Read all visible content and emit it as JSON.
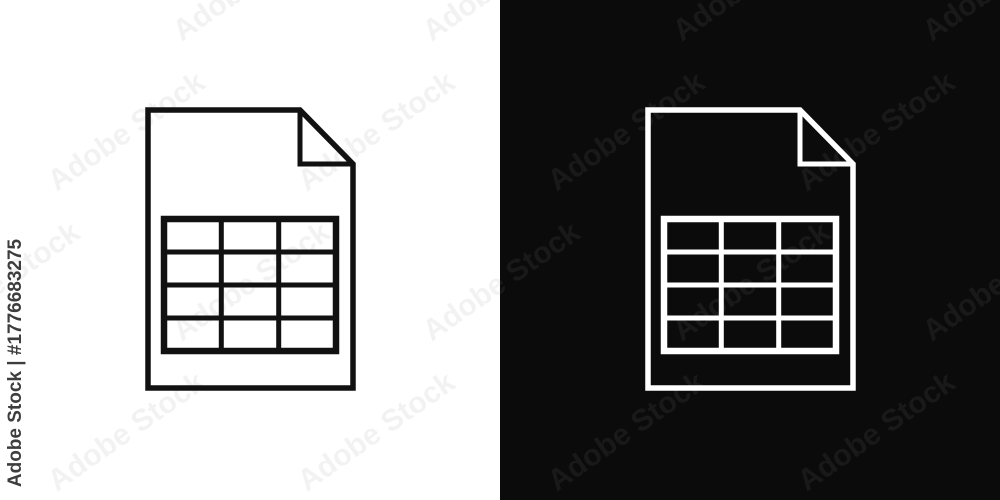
{
  "watermark": {
    "tile_text": "Adobe Stock",
    "id_text": "Adobe Stock | #1776683275"
  },
  "icon": {
    "name": "spreadsheet-file-icon",
    "description_visible_structure": {
      "table_columns": 3,
      "table_rows": 4,
      "folded_corner": "top-right"
    }
  },
  "panels": [
    {
      "id": "light",
      "background": "#ffffff",
      "icon_stroke": "#111111"
    },
    {
      "id": "dark",
      "background": "#0b0b0b",
      "icon_stroke": "#ffffff"
    }
  ],
  "colors": {
    "bg_light": "#ffffff",
    "bg_dark": "#0b0b0b",
    "stroke_light": "#111111",
    "stroke_dark": "#ffffff",
    "wm_light": "rgba(0,0,0,0.05)",
    "wm_dark": "rgba(255,255,255,0.06)",
    "id_color": "#3d3d3d"
  }
}
